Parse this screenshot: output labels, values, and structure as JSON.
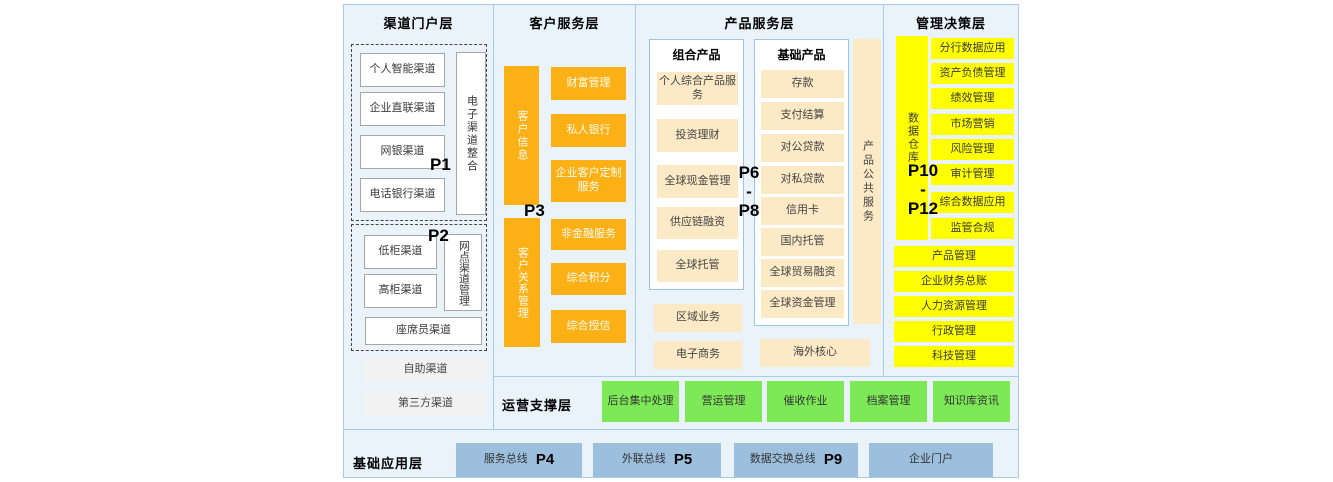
{
  "layers": {
    "channel": {
      "title": "渠道门户层",
      "p1": "P1",
      "p2": "P2",
      "group1": {
        "boxes": [
          "个人智能渠道",
          "企业直联渠道",
          "网银渠道",
          "电话银行渠道"
        ],
        "side": "电子渠道整合"
      },
      "group2": {
        "boxes": [
          "低柜渠道",
          "高柜渠道"
        ],
        "side": "网点渠道管理",
        "bottom": "座席员渠道"
      },
      "extras": [
        "自助渠道",
        "第三方渠道"
      ]
    },
    "customer": {
      "title": "客户服务层",
      "p3": "P3",
      "bars": [
        "客户信息",
        "客户关系管理"
      ],
      "boxes": [
        "财富管理",
        "私人银行",
        "企业客户定制服务",
        "非金融服务",
        "综合积分",
        "综合授信"
      ]
    },
    "product": {
      "title": "产品服务层",
      "p_range": {
        "top": "P6",
        "sep": "-",
        "bottom": "P8"
      },
      "combo": {
        "title": "组合产品",
        "boxes": [
          "个人综合产品服务",
          "投资理财",
          "全球现金管理",
          "供应链融资",
          "全球托管"
        ]
      },
      "basic": {
        "title": "基础产品",
        "boxes": [
          "存款",
          "支付结算",
          "对公贷款",
          "对私贷款",
          "信用卡",
          "国内托管",
          "全球贸易融资",
          "全球资金管理"
        ]
      },
      "strip": "产品公共服务",
      "extras": [
        "区域业务",
        "电子商务"
      ],
      "overseas": "海外核心"
    },
    "management": {
      "title": "管理决策层",
      "p_range": {
        "top": "P10",
        "sep": "-",
        "bottom": "P12"
      },
      "bar": "数据仓库",
      "boxes": [
        "分行数据应用",
        "资产负债管理",
        "绩效管理",
        "市场营销",
        "风险管理",
        "审计管理",
        "综合数据应用",
        "监管合规"
      ],
      "wide_boxes": [
        "产品管理",
        "企业财务总账",
        "人力资源管理",
        "行政管理",
        "科技管理"
      ]
    },
    "operations": {
      "title": "运营支撑层",
      "boxes": [
        "后台集中处理",
        "营运管理",
        "催收作业",
        "档案管理",
        "知识库资讯"
      ]
    },
    "foundation": {
      "title": "基础应用层",
      "buses": [
        {
          "label": "服务总线",
          "p": "P4"
        },
        {
          "label": "外联总线",
          "p": "P5"
        },
        {
          "label": "数据交换总线",
          "p": "P9"
        },
        {
          "label": "企业门户",
          "p": ""
        }
      ]
    }
  },
  "colors": {
    "background": "#EAF2FA",
    "border": "#A9C9E8",
    "orange": "#FBB116",
    "cream": "#FCE9C5",
    "yellow": "#FFFF00",
    "green": "#7EE957",
    "blue": "#9CBFDE",
    "gray_box": "#F2F2F2"
  }
}
